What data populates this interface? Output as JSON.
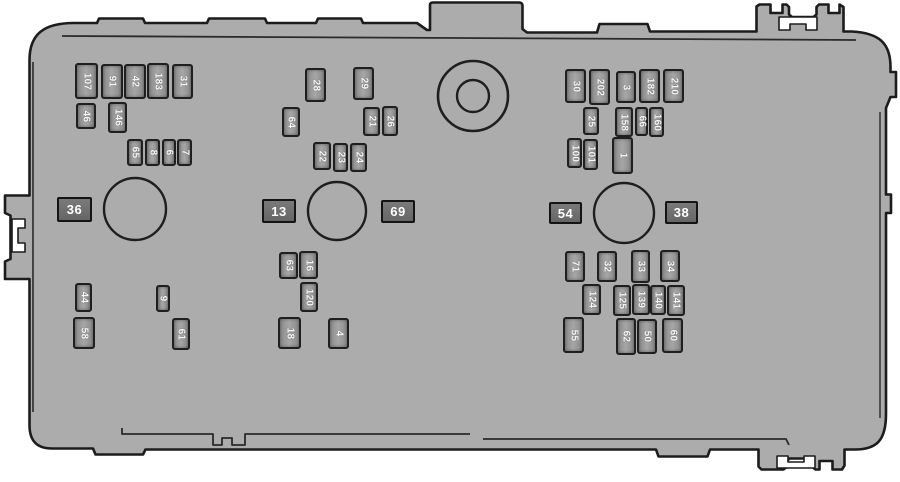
{
  "diagram": {
    "kind": "fuse-box"
  },
  "colors": {
    "background": "#ffffff",
    "body_fill": "#adacad",
    "outline": "#1c1c1c",
    "fuse_fill": "#989898",
    "fuse_border": "#1f1f1f",
    "plate_fill": "#6d6d6d",
    "label_text": "#ffffff"
  },
  "fuses": [
    {
      "id": "107",
      "x": 75,
      "y": 63,
      "w": 23,
      "h": 36
    },
    {
      "id": "91",
      "x": 101,
      "y": 64,
      "w": 22,
      "h": 35
    },
    {
      "id": "42",
      "x": 124,
      "y": 64,
      "w": 22,
      "h": 35
    },
    {
      "id": "183",
      "x": 147,
      "y": 63,
      "w": 22,
      "h": 36
    },
    {
      "id": "31",
      "x": 172,
      "y": 64,
      "w": 21,
      "h": 35
    },
    {
      "id": "46",
      "x": 76,
      "y": 103,
      "w": 20,
      "h": 26
    },
    {
      "id": "146",
      "x": 108,
      "y": 102,
      "w": 19,
      "h": 31
    },
    {
      "id": "65",
      "x": 127,
      "y": 139,
      "w": 16,
      "h": 27
    },
    {
      "id": "8",
      "x": 145,
      "y": 139,
      "w": 15,
      "h": 27
    },
    {
      "id": "6",
      "x": 162,
      "y": 139,
      "w": 14,
      "h": 27
    },
    {
      "id": "7",
      "x": 177,
      "y": 139,
      "w": 15,
      "h": 27
    },
    {
      "id": "28",
      "x": 305,
      "y": 68,
      "w": 21,
      "h": 34
    },
    {
      "id": "29",
      "x": 353,
      "y": 67,
      "w": 21,
      "h": 33
    },
    {
      "id": "64",
      "x": 282,
      "y": 107,
      "w": 18,
      "h": 30
    },
    {
      "id": "21",
      "x": 363,
      "y": 107,
      "w": 17,
      "h": 29
    },
    {
      "id": "26",
      "x": 382,
      "y": 106,
      "w": 16,
      "h": 30
    },
    {
      "id": "22",
      "x": 313,
      "y": 142,
      "w": 18,
      "h": 28
    },
    {
      "id": "23",
      "x": 333,
      "y": 143,
      "w": 15,
      "h": 29
    },
    {
      "id": "24",
      "x": 350,
      "y": 143,
      "w": 17,
      "h": 29
    },
    {
      "id": "30",
      "x": 565,
      "y": 69,
      "w": 21,
      "h": 34
    },
    {
      "id": "202",
      "x": 589,
      "y": 69,
      "w": 21,
      "h": 36
    },
    {
      "id": "3",
      "x": 616,
      "y": 71,
      "w": 20,
      "h": 32
    },
    {
      "id": "182",
      "x": 639,
      "y": 69,
      "w": 21,
      "h": 34
    },
    {
      "id": "210",
      "x": 663,
      "y": 69,
      "w": 21,
      "h": 34
    },
    {
      "id": "25",
      "x": 583,
      "y": 107,
      "w": 16,
      "h": 28
    },
    {
      "id": "158",
      "x": 615,
      "y": 107,
      "w": 18,
      "h": 30
    },
    {
      "id": "66",
      "x": 635,
      "y": 107,
      "w": 13,
      "h": 29
    },
    {
      "id": "160",
      "x": 649,
      "y": 107,
      "w": 15,
      "h": 30
    },
    {
      "id": "100",
      "x": 567,
      "y": 138,
      "w": 15,
      "h": 30
    },
    {
      "id": "101",
      "x": 583,
      "y": 139,
      "w": 15,
      "h": 31
    },
    {
      "id": "1",
      "x": 612,
      "y": 137,
      "w": 21,
      "h": 37
    },
    {
      "id": "44",
      "x": 75,
      "y": 283,
      "w": 17,
      "h": 29
    },
    {
      "id": "58",
      "x": 73,
      "y": 317,
      "w": 22,
      "h": 32
    },
    {
      "id": "9",
      "x": 156,
      "y": 285,
      "w": 14,
      "h": 27
    },
    {
      "id": "61",
      "x": 172,
      "y": 318,
      "w": 18,
      "h": 32
    },
    {
      "id": "63",
      "x": 279,
      "y": 252,
      "w": 19,
      "h": 27
    },
    {
      "id": "16",
      "x": 299,
      "y": 251,
      "w": 19,
      "h": 28
    },
    {
      "id": "120",
      "x": 300,
      "y": 282,
      "w": 18,
      "h": 30
    },
    {
      "id": "18",
      "x": 278,
      "y": 317,
      "w": 23,
      "h": 32
    },
    {
      "id": "4",
      "x": 328,
      "y": 318,
      "w": 21,
      "h": 31
    },
    {
      "id": "71",
      "x": 565,
      "y": 251,
      "w": 20,
      "h": 31
    },
    {
      "id": "32",
      "x": 597,
      "y": 251,
      "w": 20,
      "h": 31
    },
    {
      "id": "33",
      "x": 631,
      "y": 250,
      "w": 19,
      "h": 33
    },
    {
      "id": "34",
      "x": 660,
      "y": 250,
      "w": 20,
      "h": 32
    },
    {
      "id": "124",
      "x": 582,
      "y": 284,
      "w": 19,
      "h": 31
    },
    {
      "id": "125",
      "x": 613,
      "y": 285,
      "w": 18,
      "h": 31
    },
    {
      "id": "139",
      "x": 632,
      "y": 284,
      "w": 18,
      "h": 31
    },
    {
      "id": "140",
      "x": 650,
      "y": 285,
      "w": 16,
      "h": 30
    },
    {
      "id": "141",
      "x": 667,
      "y": 285,
      "w": 18,
      "h": 31
    },
    {
      "id": "55",
      "x": 563,
      "y": 317,
      "w": 21,
      "h": 36
    },
    {
      "id": "62",
      "x": 616,
      "y": 318,
      "w": 20,
      "h": 37
    },
    {
      "id": "50",
      "x": 637,
      "y": 319,
      "w": 20,
      "h": 35
    },
    {
      "id": "60",
      "x": 662,
      "y": 318,
      "w": 21,
      "h": 35
    }
  ],
  "plates": [
    {
      "id": "36",
      "x": 57,
      "y": 197,
      "w": 35,
      "h": 25
    },
    {
      "id": "13",
      "x": 262,
      "y": 199,
      "w": 34,
      "h": 24
    },
    {
      "id": "69",
      "x": 381,
      "y": 200,
      "w": 34,
      "h": 23
    },
    {
      "id": "54",
      "x": 549,
      "y": 202,
      "w": 33,
      "h": 22
    },
    {
      "id": "38",
      "x": 665,
      "y": 201,
      "w": 33,
      "h": 23
    }
  ],
  "circles": [
    {
      "name": "relay-circle-left",
      "cx": 135,
      "cy": 209,
      "r": 31
    },
    {
      "name": "relay-circle-middle",
      "cx": 337,
      "cy": 211,
      "r": 29
    },
    {
      "name": "relay-circle-right",
      "cx": 624,
      "cy": 213,
      "r": 30
    }
  ],
  "ring": {
    "name": "mount-ring",
    "cx": 473,
    "cy": 96,
    "r_outer": 35,
    "r_inner": 16
  }
}
